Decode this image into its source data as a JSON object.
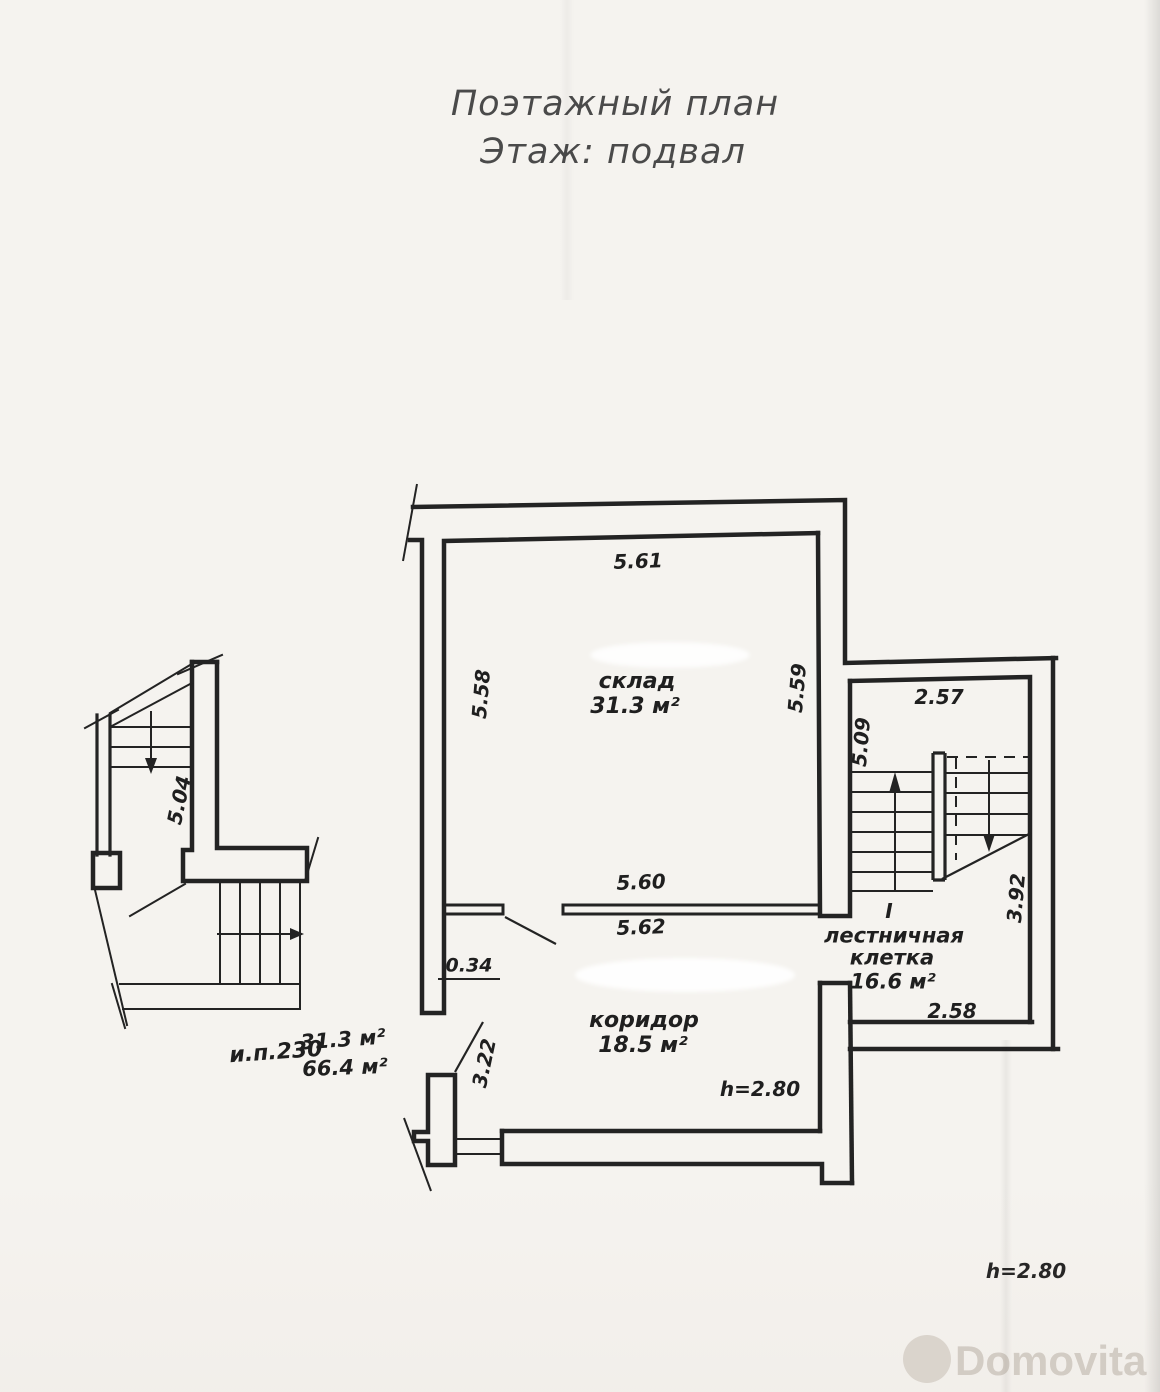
{
  "title": {
    "line1": "Поэтажный план",
    "line2": "Этаж: подвал"
  },
  "plan": {
    "rooms": {
      "sklad": {
        "name": "склад",
        "area": "31.3 м²"
      },
      "koridor": {
        "name": "коридор",
        "area": "18.5 м²"
      },
      "stair": {
        "index": "I",
        "name_line1": "лестничная",
        "name_line2": "клетка",
        "area": "16.6 м²"
      }
    },
    "dims": {
      "sklad_top": "5.61",
      "sklad_left": "5.58",
      "sklad_right": "5.59",
      "partition_top": "5.60",
      "partition_bottom": "5.62",
      "door_width": "0.34",
      "koridor_left": "3.22",
      "stair_top": "2.57",
      "stair_left": "5.09",
      "stair_right": "3.92",
      "stair_bottom": "2.58",
      "detail_stair": "5.04"
    },
    "heights": {
      "koridor": "h=2.80",
      "page_bottom": "h=2.80"
    },
    "note": {
      "unit": "и.п.230",
      "area_sklad": "31.3 м²",
      "area_total": "66.4 м²"
    }
  },
  "watermark": {
    "text": "Domovita"
  },
  "colors": {
    "ink": "#232323",
    "paper": "#f5f3ef",
    "watermark": "#d5cfc7"
  }
}
